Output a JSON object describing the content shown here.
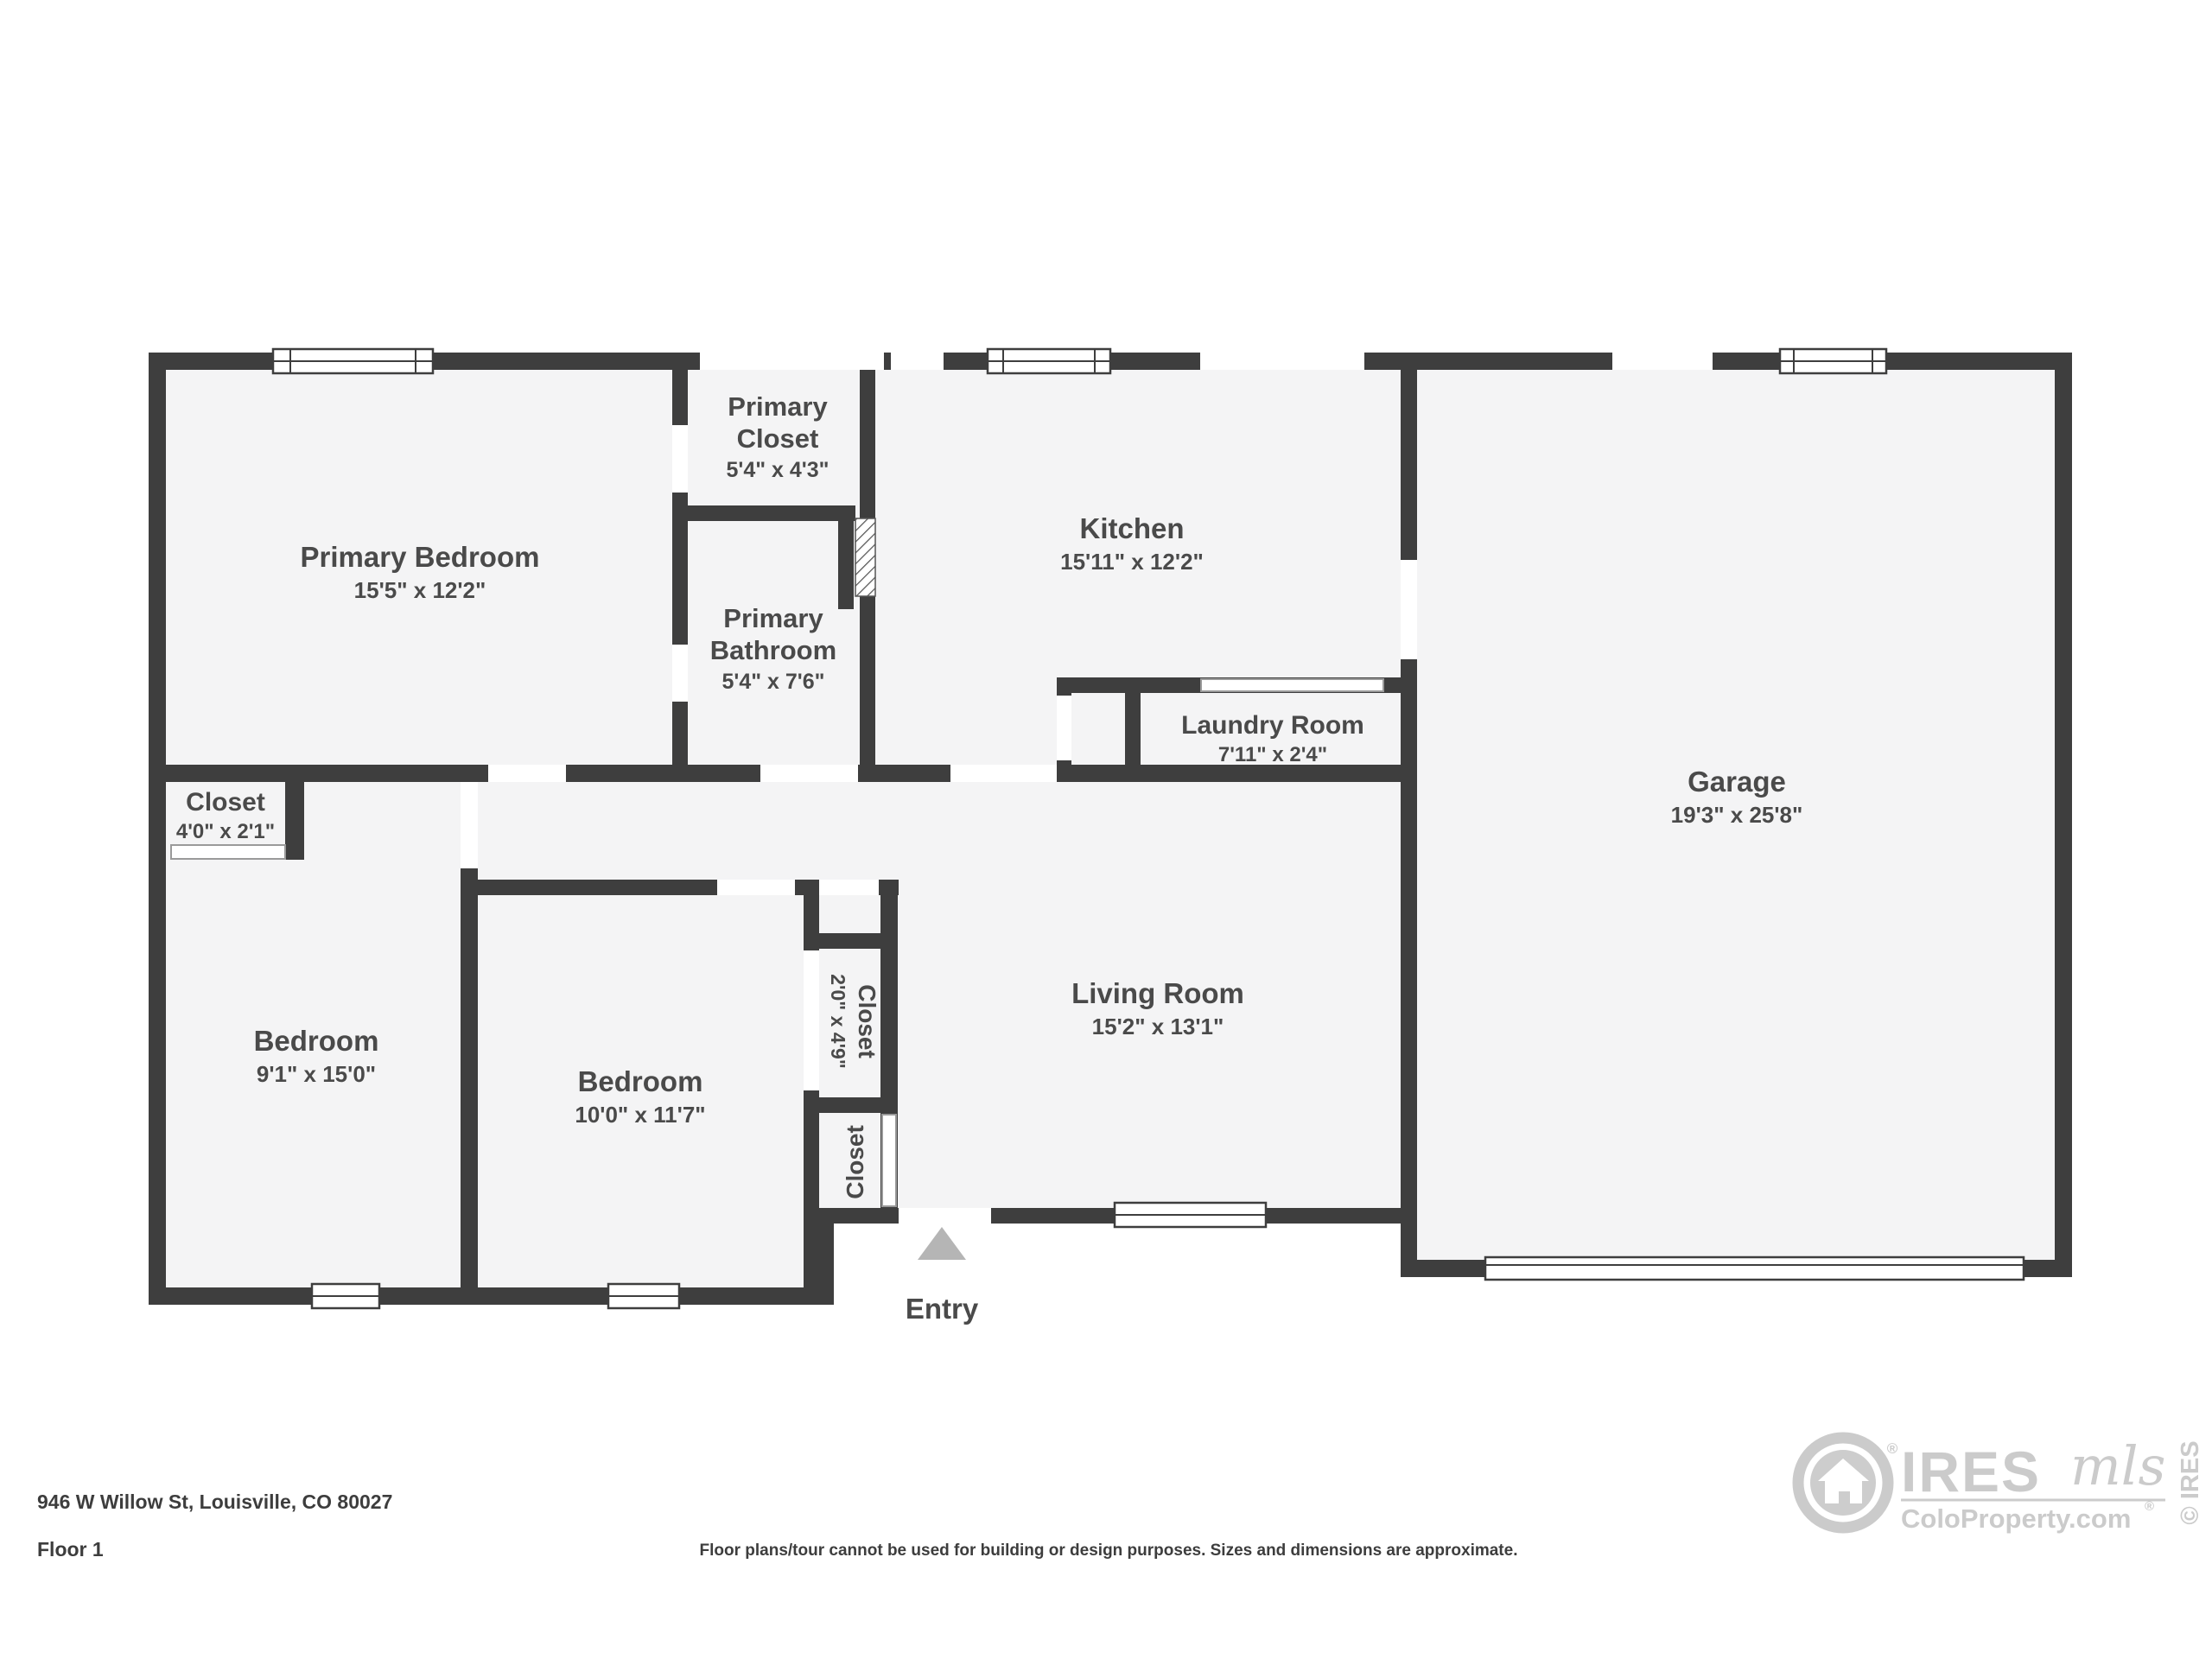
{
  "floorplan": {
    "rooms": {
      "primary_bedroom": {
        "name": "Primary Bedroom",
        "dims": "15'5\" x 12'2\""
      },
      "primary_closet": {
        "name_l1": "Primary",
        "name_l2": "Closet",
        "dims": "5'4\" x 4'3\""
      },
      "primary_bathroom": {
        "name_l1": "Primary",
        "name_l2": "Bathroom",
        "dims": "5'4\" x 7'6\""
      },
      "kitchen": {
        "name": "Kitchen",
        "dims": "15'11\" x 12'2\""
      },
      "laundry": {
        "name": "Laundry Room",
        "dims": "7'11\" x 2'4\""
      },
      "garage": {
        "name": "Garage",
        "dims": "19'3\" x 25'8\""
      },
      "living_room": {
        "name": "Living Room",
        "dims": "15'2\" x 13'1\""
      },
      "hall_closet": {
        "name": "Closet",
        "dims": "4'0\" x 2'1\""
      },
      "bedroom_west": {
        "name": "Bedroom",
        "dims": "9'1\" x 15'0\""
      },
      "bedroom_mid": {
        "name": "Bedroom",
        "dims": "10'0\" x 11'7\""
      },
      "closet_a": {
        "name": "Closet",
        "dims": "2'0\" x 4'9\""
      },
      "closet_b": {
        "name": "Closet"
      }
    },
    "entry_label": "Entry"
  },
  "footer": {
    "address": "946 W Willow St, Louisville, CO 80027",
    "floor_label": "Floor 1",
    "disclaimer": "Floor plans/tour cannot be used for building or design purposes. Sizes and dimensions are approximate."
  },
  "logo": {
    "brand": "IRES",
    "script": "mls",
    "site": "ColoProperty.com",
    "registered": "®",
    "copyright": "© IRES"
  },
  "colors": {
    "wall": "#3e3e3e",
    "floor": "#f4f4f5",
    "label": "#4a4a4a",
    "entry_triangle": "#b5b5b5",
    "logo_gray": "#cbcbcb"
  }
}
